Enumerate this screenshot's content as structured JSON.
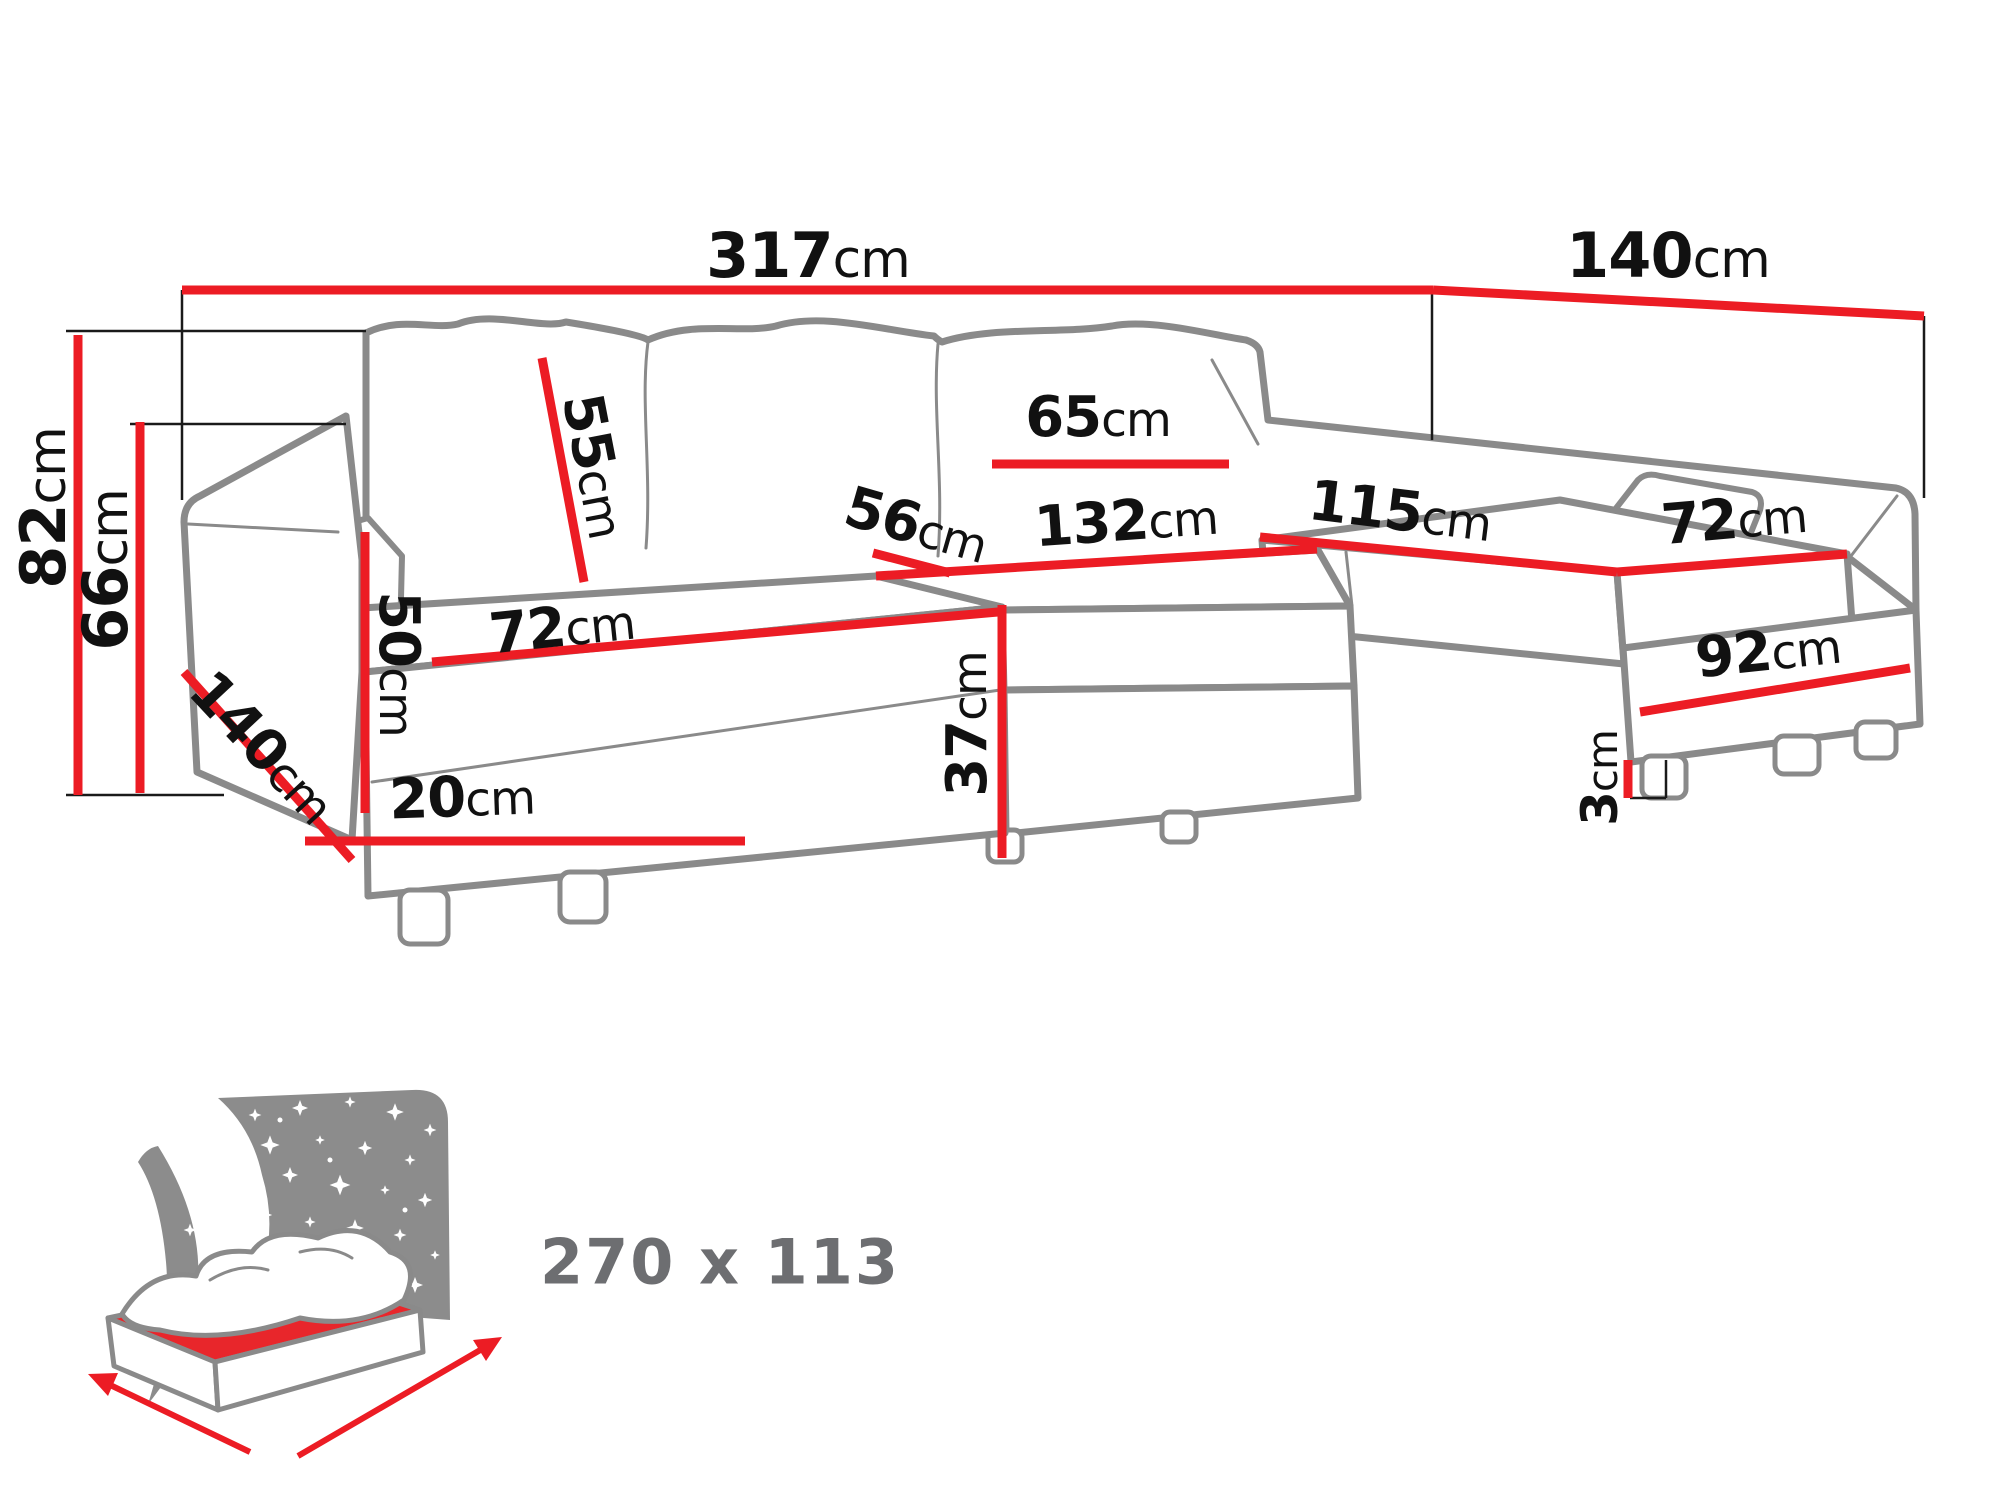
{
  "diagram": {
    "title_visible_text_only": false,
    "colors": {
      "dimension_red": "#ec1c24",
      "outline_gray": "#8a8a8a",
      "label_black": "#111111",
      "muted_gray": "#6d6e71"
    },
    "dimensions": [
      {
        "id": "total-width",
        "num": "317",
        "unit": "cm"
      },
      {
        "id": "right-depth",
        "num": "140",
        "unit": "cm"
      },
      {
        "id": "overall-height",
        "num": "82",
        "unit": "cm"
      },
      {
        "id": "arm-height",
        "num": "66",
        "unit": "cm"
      },
      {
        "id": "back-cushion",
        "num": "55",
        "unit": "cm"
      },
      {
        "id": "cushion-width",
        "num": "65",
        "unit": "cm"
      },
      {
        "id": "seat-depth",
        "num": "56",
        "unit": "cm"
      },
      {
        "id": "middle-seat-width",
        "num": "132",
        "unit": "cm"
      },
      {
        "id": "right-chaise-length",
        "num": "115",
        "unit": "cm"
      },
      {
        "id": "right-chaise-width",
        "num": "72",
        "unit": "cm"
      },
      {
        "id": "left-chaise-width",
        "num": "72",
        "unit": "cm"
      },
      {
        "id": "left-arm-panel",
        "num": "50",
        "unit": "cm"
      },
      {
        "id": "left-chaise-length",
        "num": "140",
        "unit": "cm"
      },
      {
        "id": "base-height",
        "num": "20",
        "unit": "cm"
      },
      {
        "id": "seat-height",
        "num": "37",
        "unit": "cm"
      },
      {
        "id": "right-front-height",
        "num": "92",
        "unit": "cm"
      },
      {
        "id": "leg-height",
        "num": "3",
        "unit": "cm"
      }
    ],
    "sleeping_area": {
      "label": "270 x 113",
      "icon": "sleeping-function-icon"
    }
  }
}
